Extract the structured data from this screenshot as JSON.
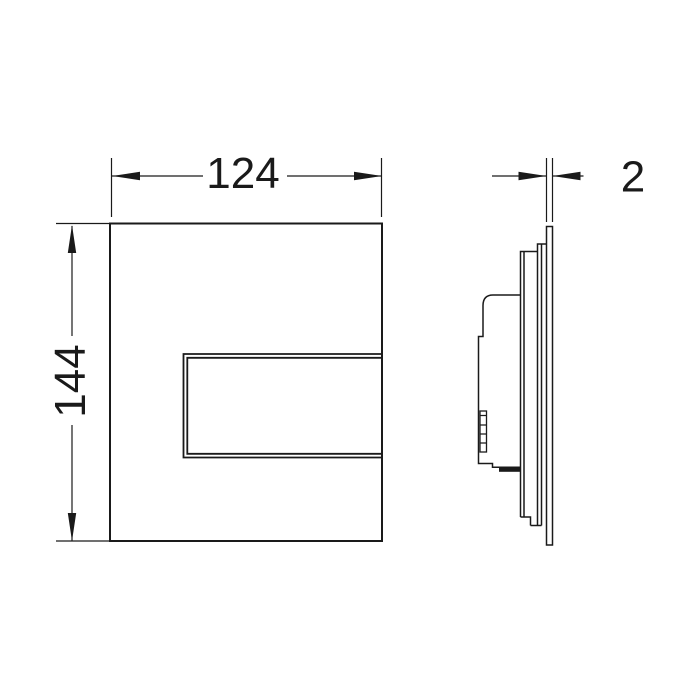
{
  "drawing": {
    "background_color": "#ffffff",
    "line_color": "#1a1a1a",
    "dimensions": {
      "width_label": "124",
      "height_label": "144",
      "thickness_label": "2"
    }
  }
}
